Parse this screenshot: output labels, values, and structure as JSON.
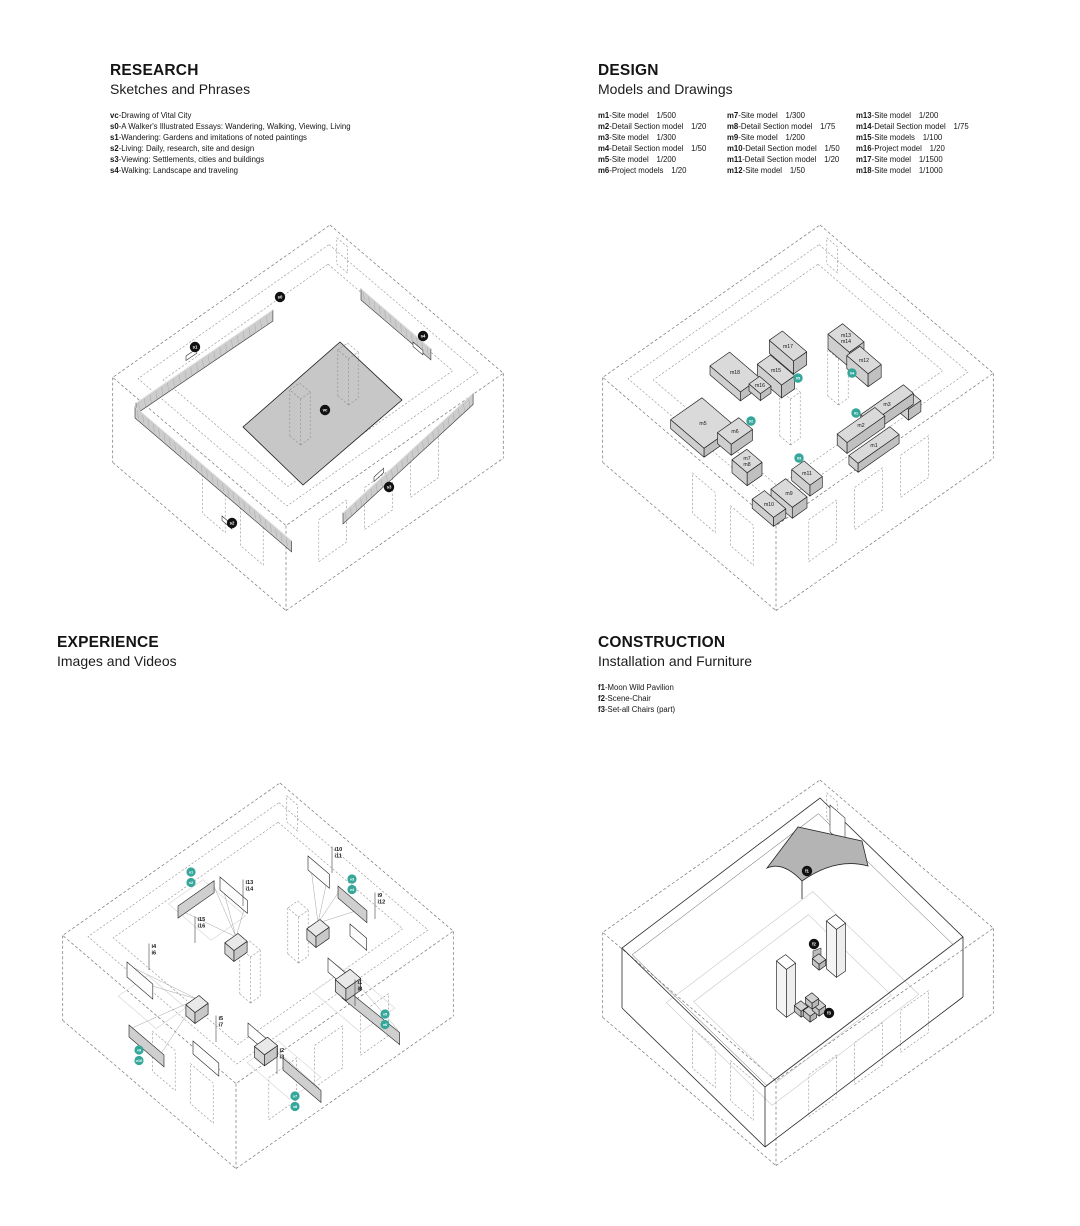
{
  "colors": {
    "teal": "#35a79a",
    "badge_black": "#111111",
    "panel_gray": "#c7c7c7",
    "line": "#222222"
  },
  "quadrants": {
    "research": {
      "title": "RESEARCH",
      "subtitle": "Sketches and Phrases",
      "legend": [
        {
          "key": "vc",
          "text": "Drawing of Vital City"
        },
        {
          "key": "s0",
          "text": "A Walker's Illustrated Essays: Wandering, Walking, Viewing, Living"
        },
        {
          "key": "s1",
          "text": "Wandering: Gardens and imitations of noted paintings"
        },
        {
          "key": "s2",
          "text": "Living: Daily, research, site and design"
        },
        {
          "key": "s3",
          "text": "Viewing: Settlements, cities and buildings"
        },
        {
          "key": "s4",
          "text": "Walking: Landscape and traveling"
        }
      ],
      "badge_labels": [
        "vc",
        "s0",
        "s1",
        "s2",
        "s3",
        "s4"
      ]
    },
    "design": {
      "title": "DESIGN",
      "subtitle": "Models and Drawings",
      "legend_columns": [
        [
          {
            "key": "m1",
            "text": "Site model",
            "scale": "1/500"
          },
          {
            "key": "m2",
            "text": "Detail Section model",
            "scale": "1/20"
          },
          {
            "key": "m3",
            "text": "Site model",
            "scale": "1/300"
          },
          {
            "key": "m4",
            "text": "Detail Section model",
            "scale": "1/50"
          },
          {
            "key": "m5",
            "text": "Site model",
            "scale": "1/200"
          },
          {
            "key": "m6",
            "text": "Project models",
            "scale": "1/20"
          }
        ],
        [
          {
            "key": "m7",
            "text": "Site model",
            "scale": "1/300"
          },
          {
            "key": "m8",
            "text": "Detail Section model",
            "scale": "1/75"
          },
          {
            "key": "m9",
            "text": "Site model",
            "scale": "1/200"
          },
          {
            "key": "m10",
            "text": "Detail Section model",
            "scale": "1/50"
          },
          {
            "key": "m11",
            "text": "Detail Section model",
            "scale": "1/20"
          },
          {
            "key": "m12",
            "text": "Site model",
            "scale": "1/50"
          }
        ],
        [
          {
            "key": "m13",
            "text": "Site model",
            "scale": "1/200"
          },
          {
            "key": "m14",
            "text": "Detail Section model",
            "scale": "1/75"
          },
          {
            "key": "m15",
            "text": "Site models",
            "scale": "1/100"
          },
          {
            "key": "m16",
            "text": "Project model",
            "scale": "1/20"
          },
          {
            "key": "m17",
            "text": "Site model",
            "scale": "1/1500"
          },
          {
            "key": "m18",
            "text": "Site model",
            "scale": "1/1000"
          }
        ]
      ],
      "block_labels": [
        [
          "m18"
        ],
        [
          "m16"
        ],
        [
          "m15"
        ],
        [
          "m17"
        ],
        [
          "m13",
          "m14"
        ],
        [
          "m12"
        ],
        [
          "m3"
        ],
        [
          "m4"
        ],
        [
          "m2"
        ],
        [
          "m1"
        ],
        [
          "m5"
        ],
        [
          "m6"
        ],
        [
          "m7",
          "m8"
        ],
        [
          "m11"
        ],
        [
          "m9"
        ],
        [
          "m10"
        ]
      ],
      "badge_labels": [
        "01",
        "02",
        "03",
        "04",
        "05"
      ]
    },
    "experience": {
      "title": "EXPERIENCE",
      "subtitle": "Images and Videos",
      "screen_labels": [
        [
          "i13",
          "i14"
        ],
        [
          "i15",
          "i16"
        ],
        [
          "i10",
          "i11"
        ],
        [
          "i9",
          "i12"
        ],
        [
          "i4",
          "i6"
        ],
        [
          "i5",
          "i7"
        ],
        [
          "i1",
          "i8"
        ],
        [
          "i2",
          "i3"
        ]
      ],
      "badge_labels": [
        [
          "v1",
          "v2"
        ],
        [
          "v3",
          "v4"
        ],
        [
          "v5",
          "v6"
        ],
        [
          "v7",
          "v8"
        ],
        [
          "v9",
          "v10"
        ]
      ]
    },
    "construction": {
      "title": "CONSTRUCTION",
      "subtitle": "Installation and Furniture",
      "legend": [
        {
          "key": "f1",
          "text": "Moon Wild Pavilion"
        },
        {
          "key": "f2",
          "text": "Scene-Chair"
        },
        {
          "key": "f3",
          "text": "Set-all Chairs (part)"
        }
      ],
      "badge_labels": [
        "f1",
        "f2",
        "f3"
      ]
    }
  }
}
